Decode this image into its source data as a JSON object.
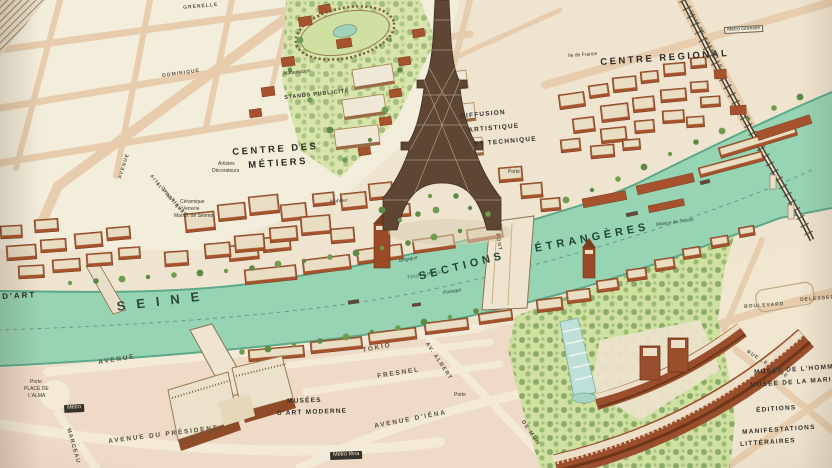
{
  "map": {
    "description": "pictorial-birds-eye-map-of-paris-exposition-with-eiffel-tower-and-seine",
    "palette": {
      "paper": "#efe4cf",
      "block_cream": "#f4eedd",
      "block_pink": "#eedac6",
      "street": "#e7cdad",
      "river": "#97d4b3",
      "river_edge": "#5ea98a",
      "brick": "#a6532d",
      "brick_dark": "#7c3c1f",
      "roof": "#e9ddc4",
      "garden": "#cfe0a0",
      "tree": "#5d8a44",
      "bridge_dark": "#473e31",
      "label": "#2e2b25"
    },
    "labels": [
      {
        "text": "CENTRE DES",
        "x": 232,
        "y": 148,
        "r": -4,
        "c": "maj"
      },
      {
        "text": "MÉTIERS",
        "x": 248,
        "y": 161,
        "r": -4,
        "c": "maj"
      },
      {
        "text": "CENTRE REGIONAL",
        "x": 600,
        "y": 58,
        "r": -4,
        "c": "maj"
      },
      {
        "text": "SEINE",
        "x": 116,
        "y": 300,
        "r": -7,
        "c": "h1"
      },
      {
        "text": "SECTIONS",
        "x": 418,
        "y": 272,
        "r": -14,
        "c": "river"
      },
      {
        "text": "ÉTRANGÈRES",
        "x": 534,
        "y": 244,
        "r": -11,
        "c": "river"
      },
      {
        "text": "D'ART",
        "x": 2,
        "y": 293,
        "r": -3,
        "c": "maj2"
      },
      {
        "text": "STANDS PUBLICITÉ",
        "x": 284,
        "y": 96,
        "r": -6,
        "c": "tinyb"
      },
      {
        "text": "DIFFUSION",
        "x": 460,
        "y": 114,
        "r": -5,
        "c": "min"
      },
      {
        "text": "ARTISTIQUE",
        "x": 468,
        "y": 128,
        "r": -5,
        "c": "min"
      },
      {
        "text": "ET TECHNIQUE",
        "x": 474,
        "y": 142,
        "r": -5,
        "c": "min"
      },
      {
        "text": "Ile de France",
        "x": 568,
        "y": 54,
        "r": -4,
        "c": "tiny"
      },
      {
        "text": "Métro Grenelle",
        "x": 724,
        "y": 27,
        "r": -3,
        "c": "chiplight"
      },
      {
        "text": "MUSÉES",
        "x": 287,
        "y": 399,
        "r": -2,
        "c": "min"
      },
      {
        "text": "D'ART MODERNE",
        "x": 277,
        "y": 411,
        "r": -2,
        "c": "min"
      },
      {
        "text": "TOKIO",
        "x": 362,
        "y": 348,
        "r": -10,
        "c": "street"
      },
      {
        "text": "FRESNEL",
        "x": 377,
        "y": 374,
        "r": -9,
        "c": "street"
      },
      {
        "text": "AVENUE D'IÉNA",
        "x": 374,
        "y": 424,
        "r": -11,
        "c": "street"
      },
      {
        "text": "AV. ALBERT",
        "x": 428,
        "y": 342,
        "r": 56,
        "c": "streetv"
      },
      {
        "text": "DE MUN",
        "x": 524,
        "y": 420,
        "r": 56,
        "c": "streetv"
      },
      {
        "text": "AVENUE",
        "x": 98,
        "y": 360,
        "r": -9,
        "c": "street"
      },
      {
        "text": "AVENUE DU PRÉSIDENT",
        "x": 108,
        "y": 439,
        "r": -7,
        "c": "street"
      },
      {
        "text": "MARCEAU",
        "x": 70,
        "y": 428,
        "r": 74,
        "c": "streetv"
      },
      {
        "text": "Porte",
        "x": 30,
        "y": 380,
        "r": 0,
        "c": "tiny"
      },
      {
        "text": "PLACE DE",
        "x": 24,
        "y": 387,
        "r": 0,
        "c": "tiny"
      },
      {
        "text": "L'ALMA",
        "x": 28,
        "y": 394,
        "r": 0,
        "c": "tiny"
      },
      {
        "text": "Métro",
        "x": 64,
        "y": 405,
        "r": -3,
        "c": "chip"
      },
      {
        "text": "Métro Iéna",
        "x": 330,
        "y": 452,
        "r": -2,
        "c": "chip"
      },
      {
        "text": "MUSÉE DE L'HOMME",
        "x": 754,
        "y": 370,
        "r": -4,
        "c": "min"
      },
      {
        "text": "MUSÉE DE LA MARINE",
        "x": 750,
        "y": 383,
        "r": -4,
        "c": "min"
      },
      {
        "text": "ÉDITIONS",
        "x": 756,
        "y": 408,
        "r": -4,
        "c": "min"
      },
      {
        "text": "MANIFESTATIONS",
        "x": 742,
        "y": 430,
        "r": -4,
        "c": "min"
      },
      {
        "text": "LITTÉRAIRES",
        "x": 740,
        "y": 442,
        "r": -4,
        "c": "min"
      },
      {
        "text": "GRENELLE",
        "x": 183,
        "y": 6,
        "r": -5,
        "c": "street2"
      },
      {
        "text": "DOMINIQUE",
        "x": 162,
        "y": 74,
        "r": -8,
        "c": "street2"
      },
      {
        "text": "BOULEVARD",
        "x": 744,
        "y": 305,
        "r": -4,
        "c": "street2"
      },
      {
        "text": "DELESSERT",
        "x": 800,
        "y": 298,
        "r": -4,
        "c": "street2"
      },
      {
        "text": "RUE LE TASSE",
        "x": 748,
        "y": 350,
        "r": 32,
        "c": "street2"
      },
      {
        "text": "PONT",
        "x": 499,
        "y": 233,
        "r": 80,
        "c": "street2"
      },
      {
        "text": "Porte",
        "x": 454,
        "y": 393,
        "r": 0,
        "c": "tiny"
      },
      {
        "text": "Porte",
        "x": 508,
        "y": 170,
        "r": 0,
        "c": "tiny"
      },
      {
        "text": "Mobilier",
        "x": 330,
        "y": 200,
        "r": -5,
        "c": "tiny"
      },
      {
        "text": "Céramique",
        "x": 180,
        "y": 200,
        "r": 0,
        "c": "tiny"
      },
      {
        "text": "Verrerie",
        "x": 182,
        "y": 207,
        "r": 0,
        "c": "tiny"
      },
      {
        "text": "Manuf. de Sèvres",
        "x": 174,
        "y": 214,
        "r": 0,
        "c": "tiny"
      },
      {
        "text": "Artistes",
        "x": 218,
        "y": 162,
        "r": 0,
        "c": "tiny"
      },
      {
        "text": "Décorateurs",
        "x": 212,
        "y": 169,
        "r": 0,
        "c": "tiny"
      },
      {
        "text": "QUAI DE GRENELLE",
        "x": 692,
        "y": 10,
        "r": 62,
        "c": "streetv2"
      },
      {
        "text": "AVENUE",
        "x": 118,
        "y": 178,
        "r": -72,
        "c": "streetv2"
      },
      {
        "text": "Belgique",
        "x": 399,
        "y": 260,
        "r": -10,
        "c": "tinyr"
      },
      {
        "text": "Portugal",
        "x": 443,
        "y": 292,
        "r": -9,
        "c": "tinyr"
      },
      {
        "text": "TOUR EIFFEL",
        "x": 407,
        "y": 276,
        "r": -10,
        "c": "tinyr2"
      },
      {
        "text": "Maison de Suisse",
        "x": 656,
        "y": 224,
        "r": -8,
        "c": "tinyr"
      },
      {
        "text": "Alimentation",
        "x": 283,
        "y": 72,
        "r": -6,
        "c": "tiny"
      },
      {
        "text": "Arts Graphiques",
        "x": 152,
        "y": 174,
        "r": 48,
        "c": "tinyv"
      },
      {
        "text": "et Plastiques",
        "x": 158,
        "y": 182,
        "r": 48,
        "c": "tinyv"
      }
    ]
  }
}
